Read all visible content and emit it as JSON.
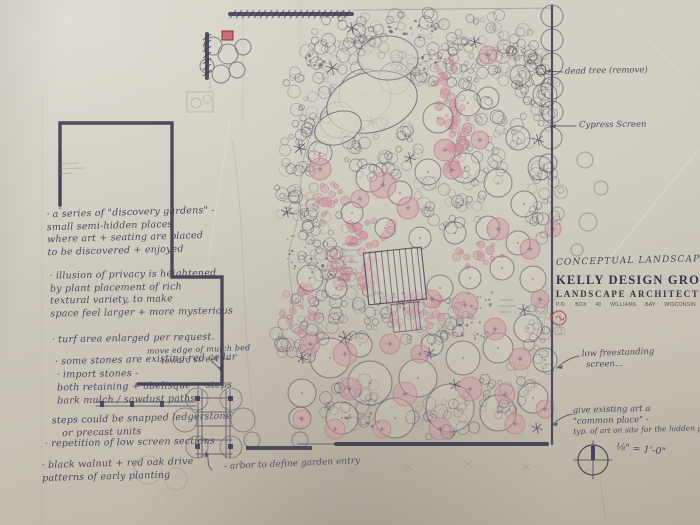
{
  "colors": {
    "paper": "#cdc9bc",
    "ink": "#4a4158",
    "ink_dark": "#3e3850",
    "pink": "#cf93a0",
    "pink_stroke": "#b5798a",
    "red_accent": "#bf4455",
    "pencil": "#8a8478"
  },
  "title_block": {
    "plan_title": "CONCEPTUAL LANDSCAPE PLAN",
    "firm_name": "KELLY DESIGN GROUP",
    "firm_suffix": "LLC",
    "firm_subtitle": "LANDSCAPE ARCHITECTURE",
    "address_line": "P.O. BOX 40 WILLIAMS BAY WISCONSIN 262"
  },
  "notes_left": [
    {
      "lines": [
        "a series of \"discovery gardens\" -",
        "small semi-hidden places",
        "where art + seating are placed",
        "to be discovered + enjoyed"
      ]
    },
    {
      "lines": [
        "illusion of privacy is heightened",
        "by plant placement of rich",
        "textural variety, to make",
        "space feel larger + more mysterious"
      ]
    },
    {
      "lines": [
        "turf area enlarged per request."
      ]
    },
    {
      "lines": [
        "some stones are existing red cedar"
      ]
    },
    {
      "lines": [
        "import stones -",
        "both retaining + obelisque + steps",
        "bark mulch / sawdust paths"
      ]
    },
    {
      "lines": [
        "steps could be snapped ledgerstone",
        "or precast units"
      ]
    },
    {
      "lines": [
        "repetition of low screen sections"
      ]
    },
    {
      "lines": [
        "black walnut + red oak drive",
        "patterns of early planting"
      ]
    }
  ],
  "side_note": {
    "lines": [
      "move edge of mulch bed",
      "toward street —"
    ]
  },
  "annotations_right": {
    "dead_tree": "dead tree (remove)",
    "cypress": "Cypress Screen",
    "screen": {
      "lines": [
        "low freestanding",
        "screen..."
      ]
    },
    "art": {
      "lines": [
        "give existing art a",
        "\"common place\" -",
        "typ. of art on site for the hidden glen"
      ]
    }
  },
  "annotation_bottom": "- arbor to define garden entry",
  "scale_note": "⅛\" = 1'-0\"",
  "bullet": "·"
}
